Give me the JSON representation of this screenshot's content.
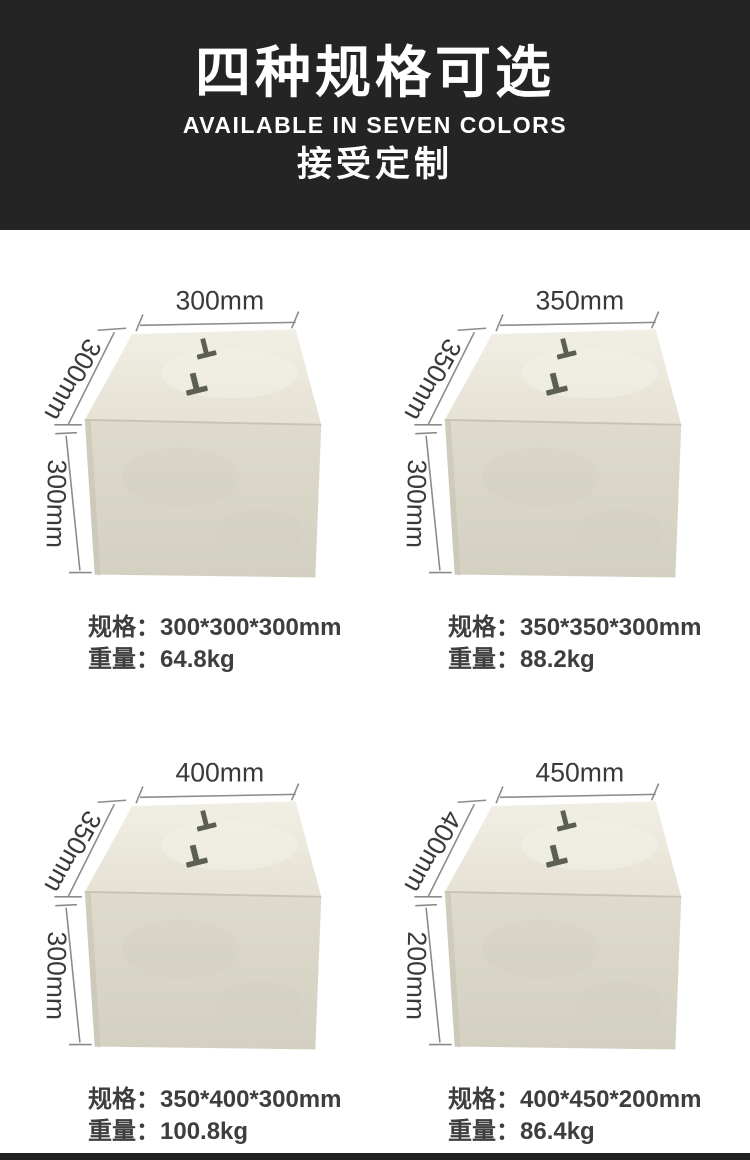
{
  "header": {
    "title": "四种规格可选",
    "subtitle": "AVAILABLE IN SEVEN COLORS",
    "tagline": "接受定制"
  },
  "labels": {
    "spec": "规格：",
    "weight": "重量："
  },
  "products": [
    {
      "dim_top": "300mm",
      "dim_side": "300mm",
      "dim_height": "300mm",
      "spec": "300*300*300mm",
      "weight": "64.8kg"
    },
    {
      "dim_top": "350mm",
      "dim_side": "350mm",
      "dim_height": "300mm",
      "spec": "350*350*300mm",
      "weight": "88.2kg"
    },
    {
      "dim_top": "400mm",
      "dim_side": "350mm",
      "dim_height": "300mm",
      "spec": "350*400*300mm",
      "weight": "100.8kg"
    },
    {
      "dim_top": "450mm",
      "dim_side": "400mm",
      "dim_height": "200mm",
      "spec": "400*450*200mm",
      "weight": "86.4kg"
    }
  ],
  "colors": {
    "header_bg": "#242424",
    "footer_bg": "#1f1f1f",
    "text_dark": "#3a3a3a",
    "block_top_face": "#ece9dd",
    "block_front_face": "#d8d5c8",
    "anchor_metal": "#5c6054",
    "dimension_line": "#8b8b8b"
  }
}
